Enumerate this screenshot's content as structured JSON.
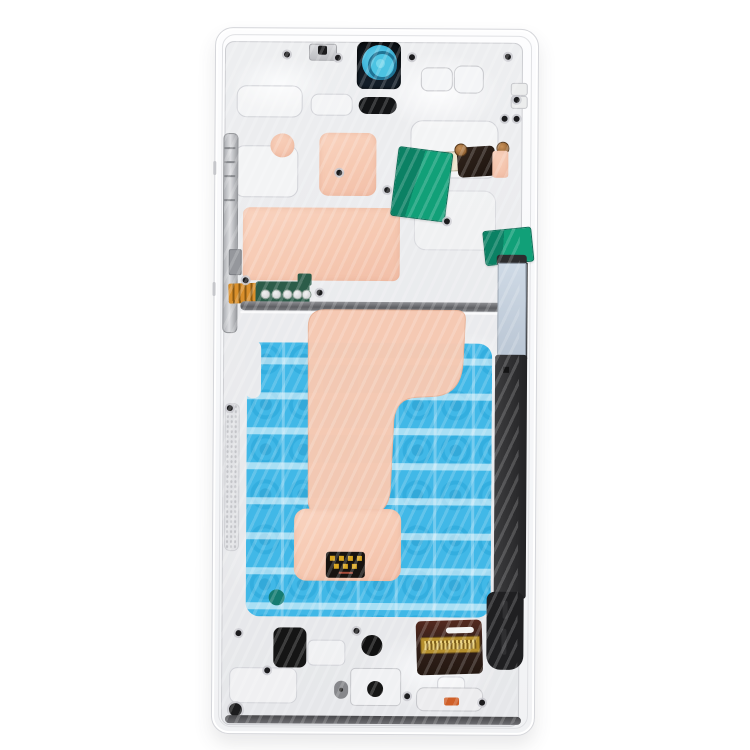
{
  "meta": {
    "description": "Product photo of a white smartphone middle frame / chassis spare part, rear view, on a plain white background",
    "orientation": "portrait",
    "background_color": "#ffffff"
  },
  "palette": {
    "frame_white": "#f6f7f9",
    "plate_silver": "#eaebee",
    "thermal_pad_pink": "#f6c9b2",
    "adhesive_film_blue": "#33b3e6",
    "film_ring_blue": "#179fd5",
    "film_band_light": "#cdeffa",
    "tape_green": "#0f9c77",
    "camera_film_blue": "#45bade",
    "pen_slot_black": "#252527",
    "pen_window_gray": "#c5d0dc",
    "connector_gold": "#c9a23a",
    "flex_orange": "#d98f2b",
    "contact_pcb_green": "#2c5c49",
    "sticker_black": "#171310",
    "teal_dot": "#157c72",
    "flex_pad_brown": "#38211b",
    "orange_chip": "#cf5f28"
  },
  "parts": {
    "frame": "Smartphone middle frame (white)",
    "plate": "Inner stamped metal plate",
    "camera": "Front camera opening with blue lens film",
    "earpiece": "Earpiece speaker slot",
    "bracket": "Top sensor bracket",
    "thermal_pad": "Pink thermal interface pad",
    "film": "Blue patterned adhesive graphite film",
    "tape": "Green adhesive tape piece",
    "rail": "Side-key flex rail",
    "flex": "Flex cable",
    "pcb": "Antenna contact PCB with five pads",
    "pen_slot": "S Pen silo",
    "pen_window": "S Pen silo window",
    "connector": "Board-to-board flex connector",
    "sticker": "Black contact sticker with gold pads",
    "speaker_pad": "Bottom speaker adhesive pad",
    "port_hole": "Bottom port opening",
    "screw": "Torx screw",
    "teal_dot": "Teal adhesive dot",
    "orange_chip": "Orange component on bottom bracket"
  }
}
